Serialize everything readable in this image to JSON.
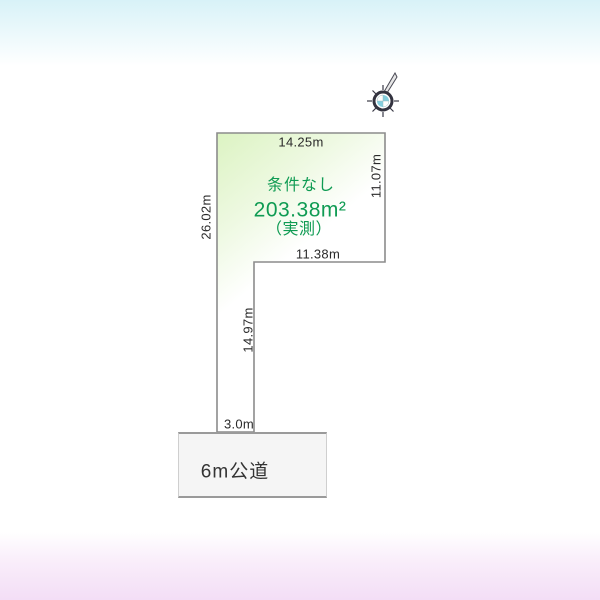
{
  "diagram": {
    "type": "land-plot-diagram",
    "plot": {
      "condition": "条件なし",
      "area": "203.38m²",
      "area_note": "（実測）",
      "dimensions": {
        "top": "14.25m",
        "left": "26.02m",
        "right": "11.07m",
        "middle": "11.38m",
        "stem": "14.97m",
        "frontage": "3.0m"
      }
    },
    "road": {
      "label": "6m公道"
    },
    "compass": {
      "name": "compass-rose",
      "needle_direction": "north-northeast"
    },
    "colors": {
      "bg_top": "#d8f2f8",
      "bg_bottom": "#f3def6",
      "plot_fill_start": "#dcf3c2",
      "plot_stroke": "#8c8c8c",
      "green_text": "#0f9b53",
      "dim_text": "#2a2a2a",
      "road_fill": "#f5f5f5",
      "road_border": "#9a9a9a",
      "compass_ring": "#33333f",
      "compass_petal": "#84cede"
    }
  }
}
